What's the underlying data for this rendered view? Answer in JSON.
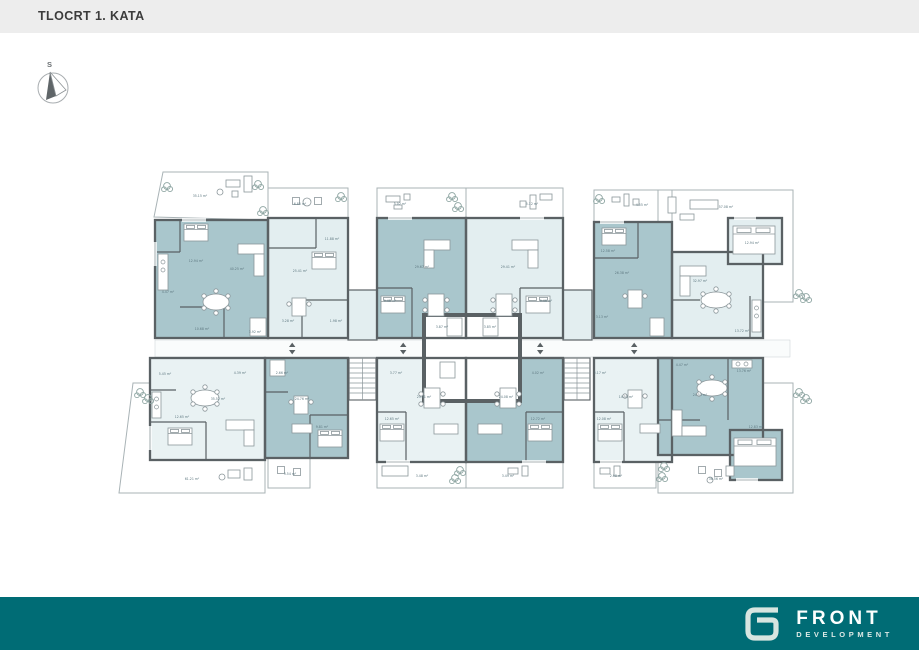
{
  "header": {
    "title": "TLOCRT 1. KATA"
  },
  "compass": {
    "label": "S"
  },
  "footer": {
    "brand": "FRONT",
    "tagline": "DEVELOPMENT"
  },
  "colors": {
    "topbar": "#EDEDED",
    "title_text": "#3C3C3C",
    "wall": "#5A6164",
    "unit_dark_teal": "#A9C6CC",
    "unit_light_teal": "#E3EEF0",
    "terrace_light": "#EFF5F6",
    "footer_teal": "#006C75",
    "logo_mark": "#D8E5E0",
    "area_label": "#5E7880"
  },
  "plan": {
    "area_labels": [
      {
        "text": "35.15 m²",
        "x": 200,
        "y": 197
      },
      {
        "text": "12.94 m²",
        "x": 196,
        "y": 262
      },
      {
        "text": "40.25 m²",
        "x": 237,
        "y": 270
      },
      {
        "text": "4.47 m²",
        "x": 168,
        "y": 293
      },
      {
        "text": "10.68 m²",
        "x": 202,
        "y": 330
      },
      {
        "text": "3.92 m²",
        "x": 255,
        "y": 333
      },
      {
        "text": "6.85 m²",
        "x": 300,
        "y": 205
      },
      {
        "text": "25.41 m²",
        "x": 300,
        "y": 272
      },
      {
        "text": "11.88 m²",
        "x": 332,
        "y": 240
      },
      {
        "text": "3.28 m²",
        "x": 288,
        "y": 322
      },
      {
        "text": "1.98 m²",
        "x": 336,
        "y": 322
      },
      {
        "text": "5.02 m²",
        "x": 400,
        "y": 205
      },
      {
        "text": "29.67 m²",
        "x": 422,
        "y": 268
      },
      {
        "text": "9.48 m²",
        "x": 390,
        "y": 302
      },
      {
        "text": "3.87 m²",
        "x": 442,
        "y": 328
      },
      {
        "text": "5.12 m²",
        "x": 532,
        "y": 205
      },
      {
        "text": "29.41 m²",
        "x": 508,
        "y": 268
      },
      {
        "text": "9.46 m²",
        "x": 546,
        "y": 302
      },
      {
        "text": "3.85 m²",
        "x": 490,
        "y": 328
      },
      {
        "text": "4.55 m²",
        "x": 642,
        "y": 206
      },
      {
        "text": "26.38 m²",
        "x": 622,
        "y": 274
      },
      {
        "text": "12.58 m²",
        "x": 608,
        "y": 252
      },
      {
        "text": "3.13 m²",
        "x": 602,
        "y": 318
      },
      {
        "text": "57.08 m²",
        "x": 726,
        "y": 208
      },
      {
        "text": "32.97 m²",
        "x": 700,
        "y": 282
      },
      {
        "text": "12.94 m²",
        "x": 752,
        "y": 244
      },
      {
        "text": "13.72 m²",
        "x": 742,
        "y": 332
      },
      {
        "text": "61.21 m²",
        "x": 192,
        "y": 480
      },
      {
        "text": "35.52 m²",
        "x": 218,
        "y": 400
      },
      {
        "text": "12.65 m²",
        "x": 182,
        "y": 418
      },
      {
        "text": "5.45 m²",
        "x": 165,
        "y": 375
      },
      {
        "text": "4.39 m²",
        "x": 240,
        "y": 374
      },
      {
        "text": "24.76 m²",
        "x": 302,
        "y": 400
      },
      {
        "text": "9.81 m²",
        "x": 322,
        "y": 428
      },
      {
        "text": "2.66 m²",
        "x": 282,
        "y": 374
      },
      {
        "text": "3.54 m²",
        "x": 290,
        "y": 475
      },
      {
        "text": "23.91 m²",
        "x": 424,
        "y": 398
      },
      {
        "text": "12.65 m²",
        "x": 392,
        "y": 420
      },
      {
        "text": "3.77 m²",
        "x": 396,
        "y": 374
      },
      {
        "text": "3.48 m²",
        "x": 422,
        "y": 477
      },
      {
        "text": "24.08 m²",
        "x": 506,
        "y": 398
      },
      {
        "text": "12.72 m²",
        "x": 538,
        "y": 420
      },
      {
        "text": "4.02 m²",
        "x": 538,
        "y": 374
      },
      {
        "text": "3.49 m²",
        "x": 508,
        "y": 477
      },
      {
        "text": "14.55 m²",
        "x": 626,
        "y": 398
      },
      {
        "text": "12.08 m²",
        "x": 604,
        "y": 420
      },
      {
        "text": "3.17 m²",
        "x": 600,
        "y": 374
      },
      {
        "text": "2.98 m²",
        "x": 616,
        "y": 477
      },
      {
        "text": "24.53 m²",
        "x": 700,
        "y": 396
      },
      {
        "text": "13.76 m²",
        "x": 744,
        "y": 372
      },
      {
        "text": "12.83 m²",
        "x": 756,
        "y": 428
      },
      {
        "text": "36.56 m²",
        "x": 716,
        "y": 480
      },
      {
        "text": "4.47 m²",
        "x": 682,
        "y": 366
      }
    ]
  }
}
